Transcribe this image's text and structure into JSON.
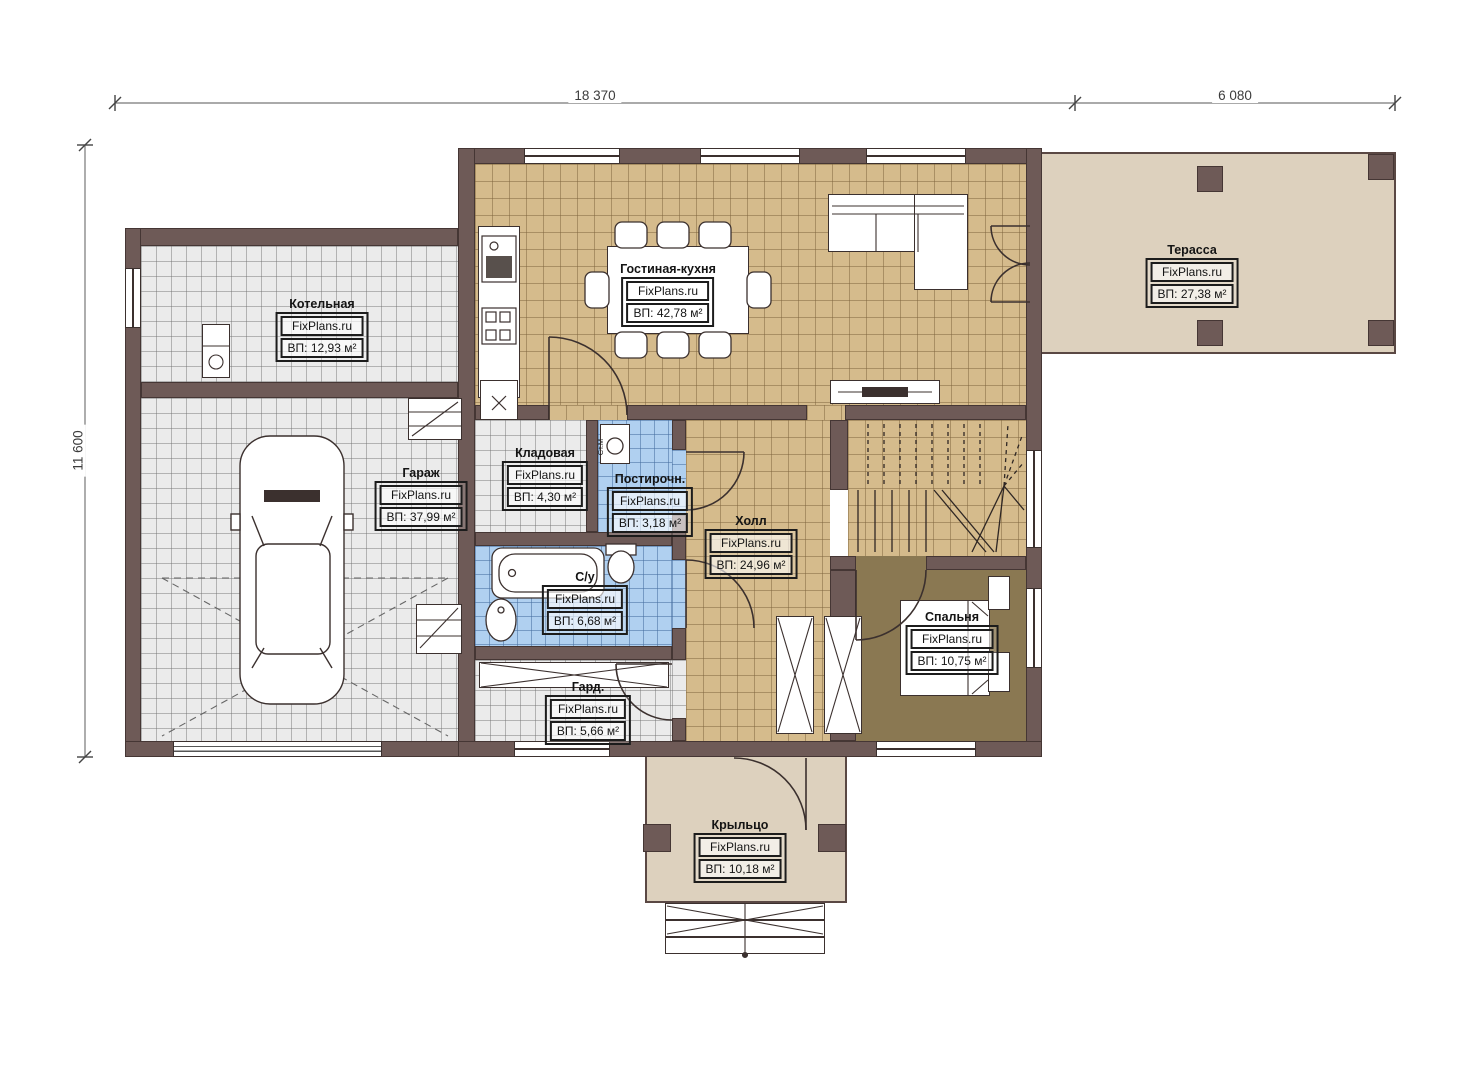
{
  "brand": "FixPlans.ru",
  "dimensions": {
    "top_width": "18 370",
    "terrace_width": "6 080",
    "left_height": "11 600"
  },
  "rooms": [
    {
      "name": "Котельная",
      "area": "ВП: 12,93 м²"
    },
    {
      "name": "Гараж",
      "area": "ВП: 37,99 м²"
    },
    {
      "name": "Гостиная-кухня",
      "area": "ВП: 42,78 м²"
    },
    {
      "name": "Терасса",
      "area": "ВП: 27,38 м²"
    },
    {
      "name": "Кладовая",
      "area": "ВП: 4,30 м²"
    },
    {
      "name": "Постирочн.",
      "area": "ВП: 3,18 м²"
    },
    {
      "name": "Холл",
      "area": "ВП: 24,96 м²"
    },
    {
      "name": "С/у",
      "area": "ВП: 6,68 м²"
    },
    {
      "name": "Гард.",
      "area": "ВП: 5,66 м²"
    },
    {
      "name": "Спальня",
      "area": "ВП: 10,75 м²"
    },
    {
      "name": "Крыльцо",
      "area": "ВП: 10,18 м²"
    }
  ],
  "annotations": {
    "washing_machine": "Ст.М"
  },
  "colors": {
    "wall": "#6e5a57",
    "floor_tan": "#d5bb8c",
    "floor_blue": "#b0d0f0",
    "floor_gray": "#ebebeb",
    "floor_olive": "#8a7852",
    "floor_beige": "#ddd1be"
  }
}
